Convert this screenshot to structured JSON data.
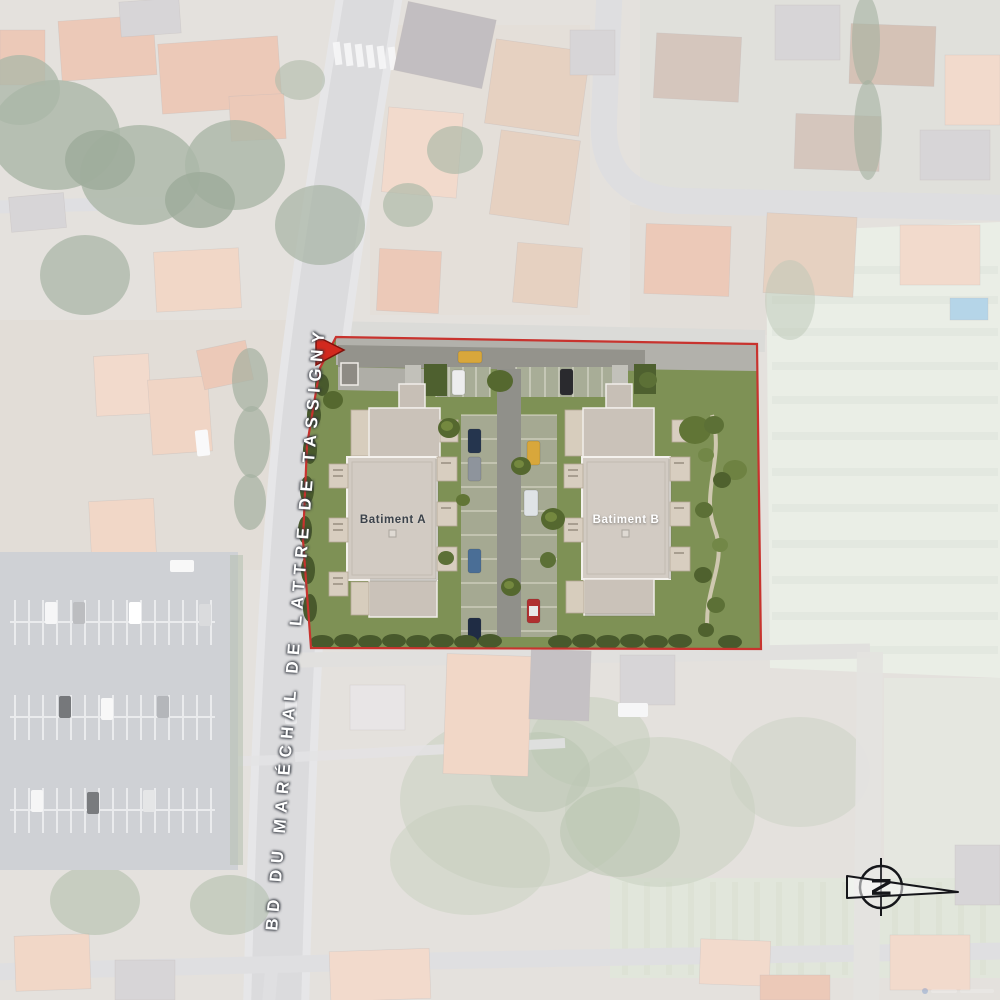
{
  "site_plan": {
    "buildings": {
      "a": {
        "label": "Batiment A",
        "label_color": "#3b424a"
      },
      "b": {
        "label": "Batiment B",
        "label_color": "#ffffff"
      }
    },
    "colors": {
      "boundary": "#c8332e",
      "entrance_arrow": "#d2291e",
      "lawn": "#7e9155",
      "building_roof": "#d2cbc3"
    }
  },
  "street_label": {
    "text": "BD DU MARÉCHAL DE LATTRE DE TASSIGNY",
    "color": "#ffffff"
  },
  "compass": {
    "letter": "N"
  }
}
